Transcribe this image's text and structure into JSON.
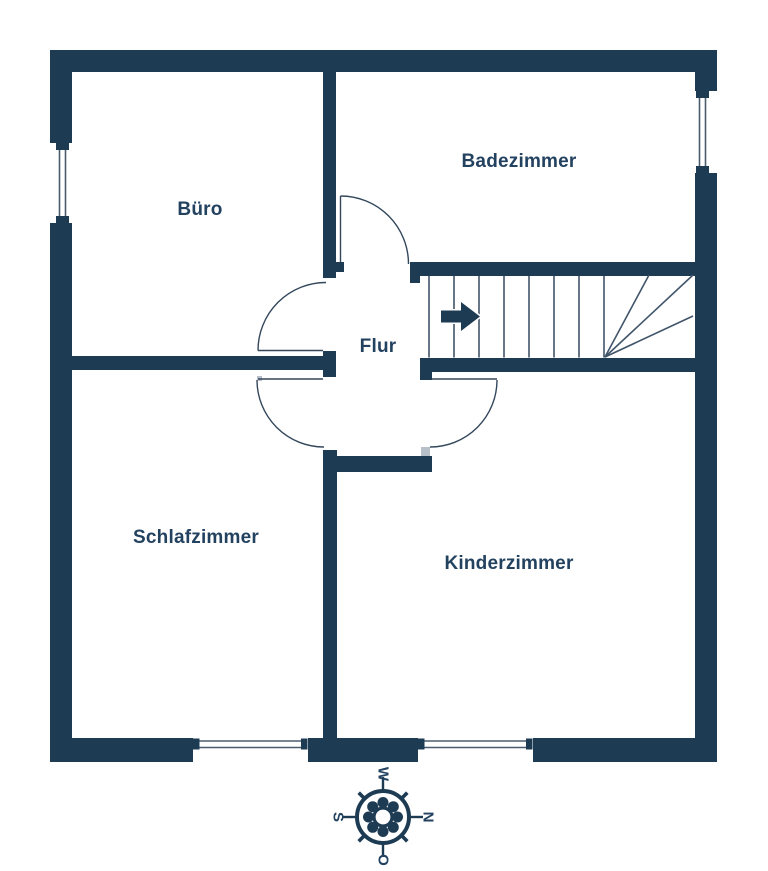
{
  "colors": {
    "wall": "#1e3b54",
    "label": "#234260",
    "line": "#33475c",
    "tread": "#41556b",
    "window_line": "#4a5d70",
    "jamb": "#b7bfc8",
    "background": "#ffffff"
  },
  "rooms": {
    "buero": {
      "label": "Büro"
    },
    "badezimmer": {
      "label": "Badezimmer"
    },
    "flur": {
      "label": "Flur"
    },
    "schlafzimmer": {
      "label": "Schlafzimmer"
    },
    "kinderzimmer": {
      "label": "Kinderzimmer"
    }
  },
  "compass": {
    "top": "W",
    "right": "N",
    "left": "S",
    "bottom": "O"
  }
}
